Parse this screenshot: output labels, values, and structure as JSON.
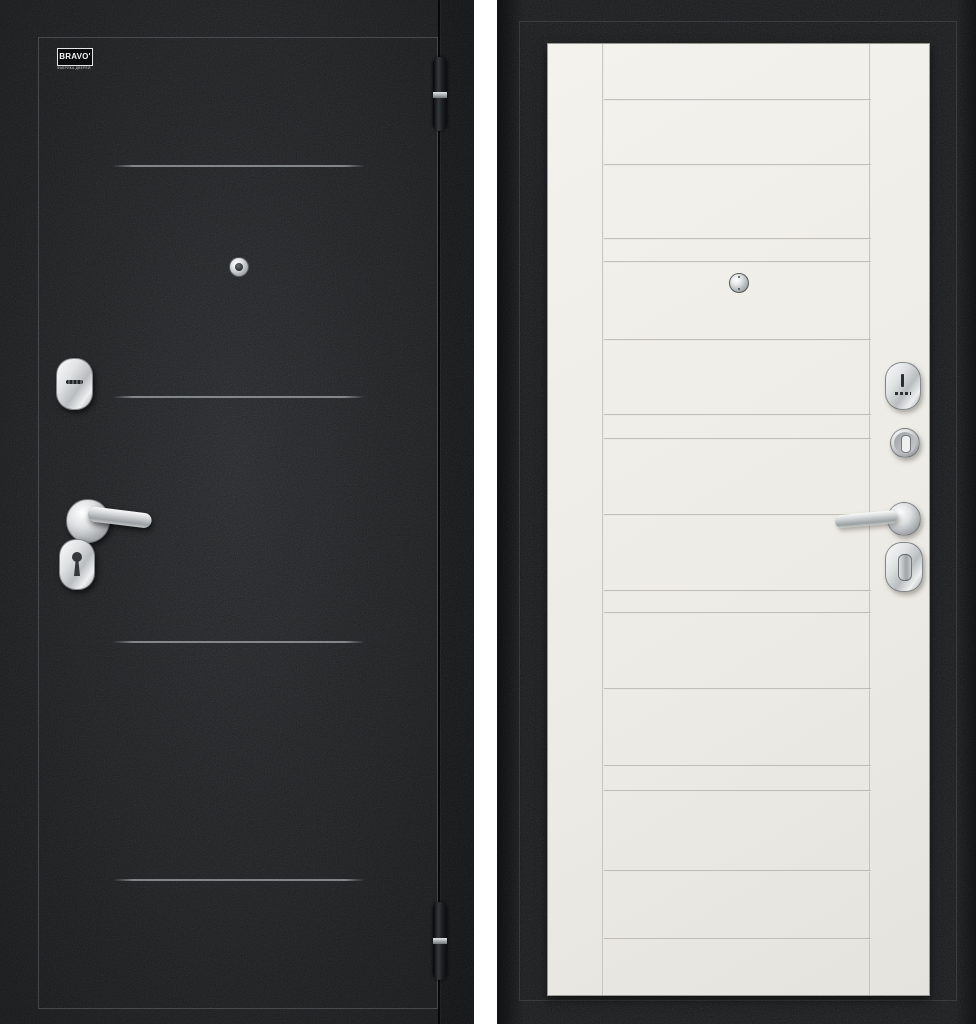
{
  "brand_plate": {
    "name": "BRAVO'",
    "subtitle": "ФАБРИКА ДВЕРЕЙ"
  },
  "views": {
    "exterior": {
      "label": "exterior-side",
      "finish_color": "#1c1f21"
    },
    "interior": {
      "label": "interior-side",
      "panel_color": "#efede7",
      "frame_color": "#17191b"
    }
  },
  "hardware": {
    "chrome_color": "#c9cccd",
    "exterior_items": [
      "peephole",
      "cylinder-escutcheon",
      "lever-handle",
      "keyhole-escutcheon",
      "hinge-top",
      "hinge-bottom"
    ],
    "interior_items": [
      "peephole",
      "key-escutcheon",
      "night-latch-knob",
      "lever-handle",
      "thumbturn"
    ]
  },
  "background_color": "#ffffff"
}
